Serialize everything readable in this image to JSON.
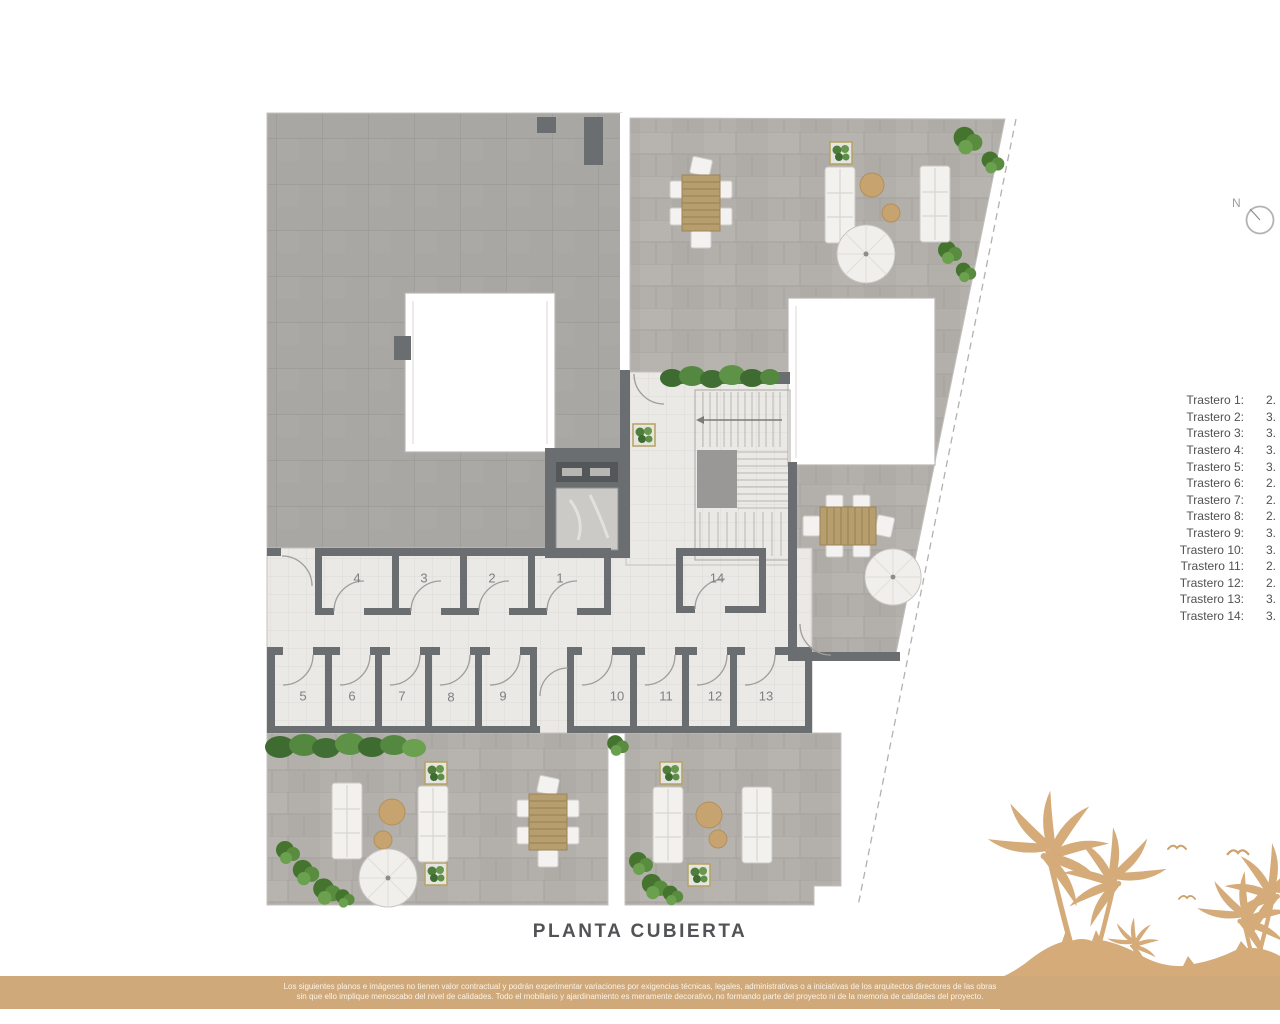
{
  "page": {
    "title": "PLANTA CUBIERTA"
  },
  "compass": {
    "label": "N"
  },
  "storage_list": {
    "items": [
      {
        "label": "Trastero 1:",
        "value": "2."
      },
      {
        "label": "Trastero 2:",
        "value": "3."
      },
      {
        "label": "Trastero 3:",
        "value": "3."
      },
      {
        "label": "Trastero 4:",
        "value": "3."
      },
      {
        "label": "Trastero 5:",
        "value": "3."
      },
      {
        "label": "Trastero 6:",
        "value": "2."
      },
      {
        "label": "Trastero 7:",
        "value": "2."
      },
      {
        "label": "Trastero 8:",
        "value": "2."
      },
      {
        "label": "Trastero 9:",
        "value": "3."
      },
      {
        "label": "Trastero 10:",
        "value": "3."
      },
      {
        "label": "Trastero 11:",
        "value": "2."
      },
      {
        "label": "Trastero 12:",
        "value": "2."
      },
      {
        "label": "Trastero 13:",
        "value": "3."
      },
      {
        "label": "Trastero 14:",
        "value": "3."
      }
    ]
  },
  "plan": {
    "room_numbers": [
      "4",
      "3",
      "2",
      "1",
      "14",
      "5",
      "6",
      "7",
      "8",
      "9",
      "10",
      "11",
      "12",
      "13"
    ]
  },
  "footer": {
    "disclaimer_line1": "Los siguientes planos e imágenes no tienen valor contractual y podrán experimentar variaciones por exigencias técnicas, legales, administrativas o a iniciativas de los arquitectos directores de las obras",
    "disclaimer_line2": "sin que ello implique menoscabo del nivel de calidades. Todo el mobiliario y ajardinamiento es meramente decorativo, no formando parte del proyecto ni de la memoria de calidades del proyecto."
  },
  "colors": {
    "accent_tan": "#d0a97b",
    "palm_tan": "#d4ab79",
    "wall_gray": "#6b6e70",
    "text_dark": "#515356",
    "plant_green": "#4e7d3c"
  }
}
